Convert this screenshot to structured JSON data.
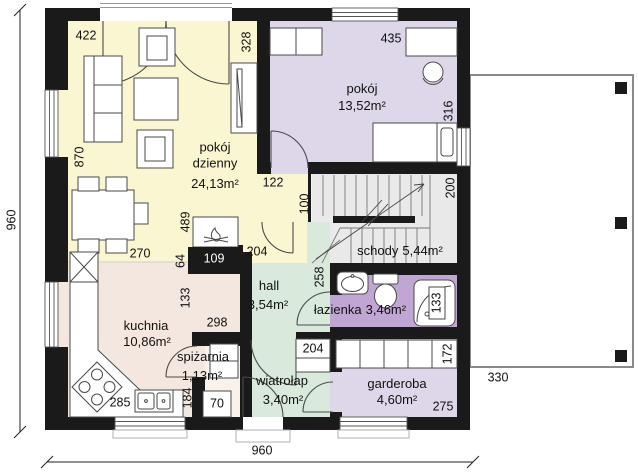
{
  "plan": {
    "rooms": {
      "living": {
        "name": "pokój dzienny",
        "area": "24,13m²",
        "color": "#faf6d2"
      },
      "bedroom": {
        "name": "pokój",
        "area": "13,52m²",
        "color": "#ded7ea"
      },
      "stairs": {
        "name": "schody",
        "area": "5,44m²",
        "color": "#e9e9e9"
      },
      "hall": {
        "name": "hall",
        "area": "3,54m²",
        "color": "#d9e9dc"
      },
      "bathroom": {
        "name": "łazienka",
        "area": "3,46m²",
        "color": "#c1a6d4"
      },
      "kitchen": {
        "name": "kuchnia",
        "area": "10,86m²",
        "color": "#f4e7df"
      },
      "pantry": {
        "name": "spiżarnia",
        "area": "1,13m²",
        "color": "#f8f1ec"
      },
      "vestibule": {
        "name": "wiatrołap",
        "area": "3,40m²",
        "color": "#d9e9dc"
      },
      "wardrobe": {
        "name": "garderoba",
        "area": "4,60m²",
        "color": "#ded7ea"
      }
    },
    "dims": {
      "v422": "422",
      "v328": "328",
      "v435": "435",
      "v316": "316",
      "v870": "870",
      "v122": "122",
      "v100": "100",
      "v200": "200",
      "v489": "489",
      "v64": "64",
      "v109": "109",
      "v204_living": "204",
      "v270": "270",
      "v258": "258",
      "v133_kitchen": "133",
      "v298": "298",
      "v133_shower": "133",
      "v204_vestibule": "204",
      "v172": "172",
      "v285": "285",
      "v184": "184",
      "v70": "70",
      "v275": "275",
      "v330": "330",
      "total_width": "960",
      "total_height": "960"
    },
    "colors": {
      "wall": "#1a1a1a",
      "terrace_border": "#8a8a8a",
      "furniture_stroke": "#4a4a4a"
    }
  }
}
